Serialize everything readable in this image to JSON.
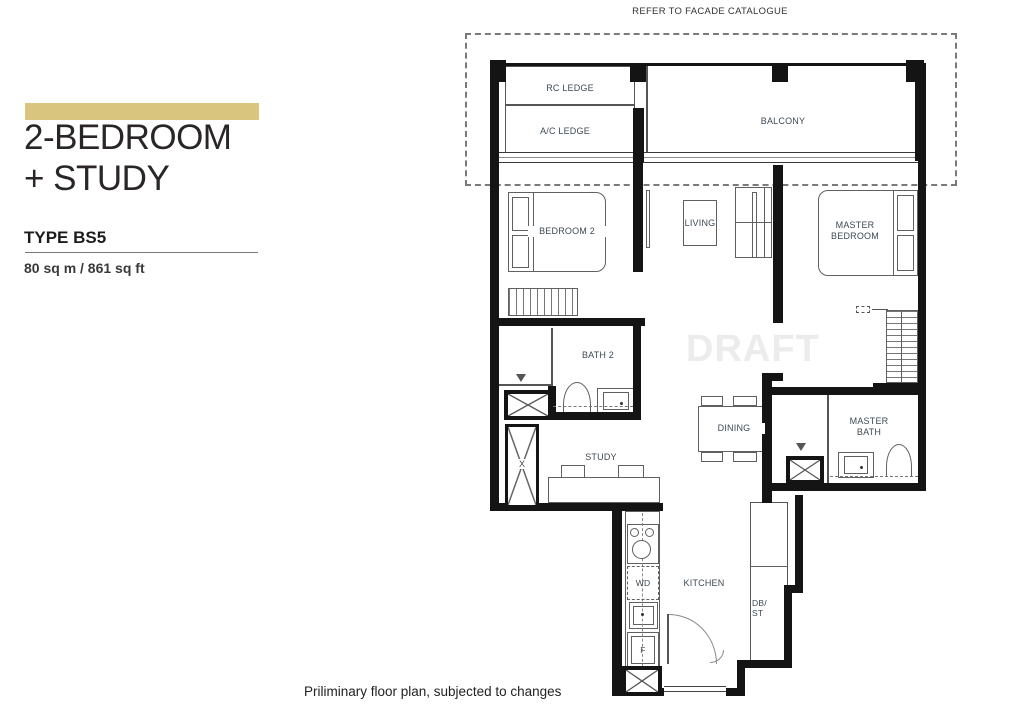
{
  "panel": {
    "title1": "2-BEDROOM",
    "title2": "+ STUDY",
    "type": "TYPE BS5",
    "area": "80 sq m / 861 sq ft"
  },
  "plan": {
    "facade_note": "REFER TO FACADE CATALOGUE",
    "watermark": "DRAFT",
    "disclaimer": "Priliminary floor plan, subjected to changes",
    "rooms": {
      "rc_ledge": "RC LEDGE",
      "ac_ledge": "A/C LEDGE",
      "balcony": "BALCONY",
      "bedroom2": "BEDROOM 2",
      "living": "LIVING",
      "master_bedroom": "MASTER BEDROOM",
      "bath2": "BATH 2",
      "study": "STUDY",
      "dining": "DINING",
      "master_bath": "MASTER BATH",
      "kitchen": "KITCHEN"
    },
    "appliances": {
      "wd": "WD",
      "fridge": "F",
      "db_st": "DB/ ST",
      "riser": "X"
    },
    "colors": {
      "accent_bar": "#d9c57e",
      "wall": "#141414",
      "label": "#3d4a55"
    }
  }
}
